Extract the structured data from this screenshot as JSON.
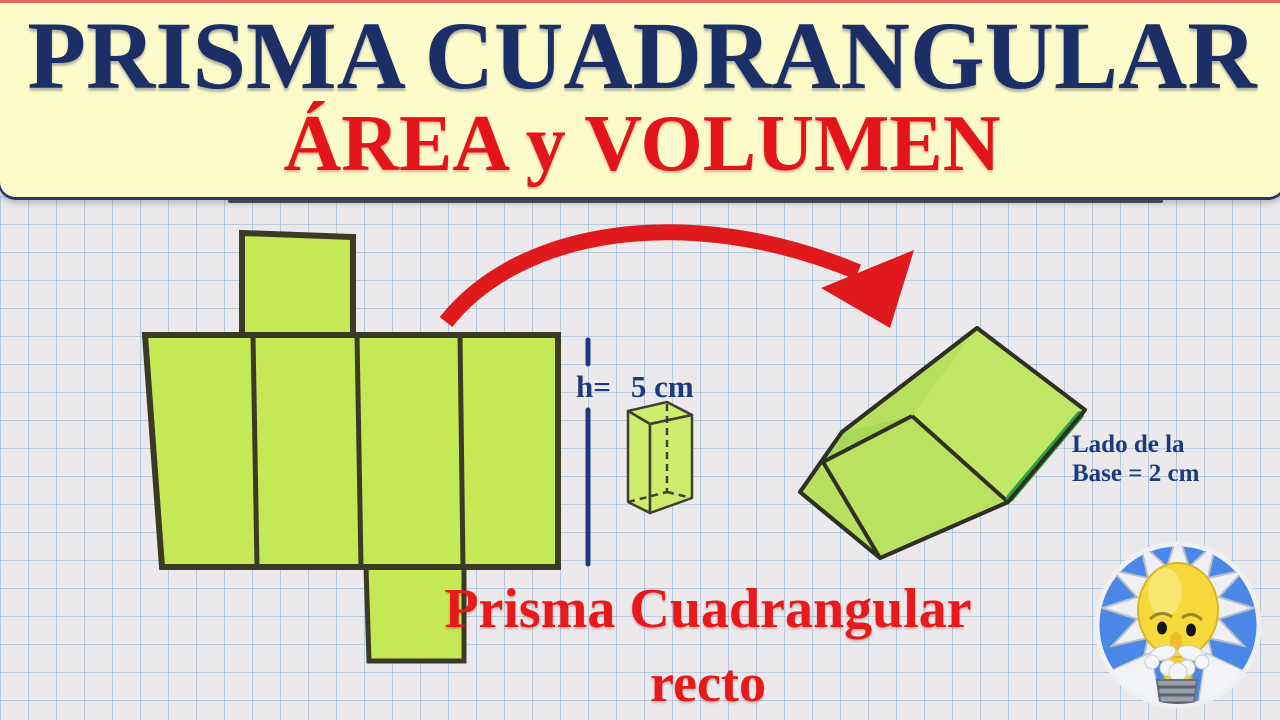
{
  "header": {
    "title": "PRISMA CUADRANGULAR",
    "subtitle": "ÁREA y VOLUMEN",
    "background_color": "#fdfbc9",
    "title_color": "#1c2e66",
    "subtitle_color": "#e3151a"
  },
  "measure": {
    "label": "h=",
    "value": "5 cm",
    "color": "#1d3a7c"
  },
  "base_label": {
    "line1": "Lado de la",
    "line2": "Base = 2 cm",
    "color": "#1d3a7c"
  },
  "caption": {
    "line1": "Prisma Cuadrangular",
    "line2": "recto",
    "color": "#e7191b"
  },
  "figures": {
    "net_fill": "#c6e854",
    "net_stroke": "#3a3a26",
    "small_prism_fill": "#d0ec6e",
    "folded_prism_fill": "#b7e05f",
    "folded_prism_edge_highlight": "#2ba344",
    "arrow_color": "#e0191c",
    "logo_icon": "einstein-lightbulb-logo",
    "logo_background": "#4a87e6"
  },
  "paper": {
    "background": "#ebe9ec",
    "grid_color": "#7aa2c6"
  }
}
